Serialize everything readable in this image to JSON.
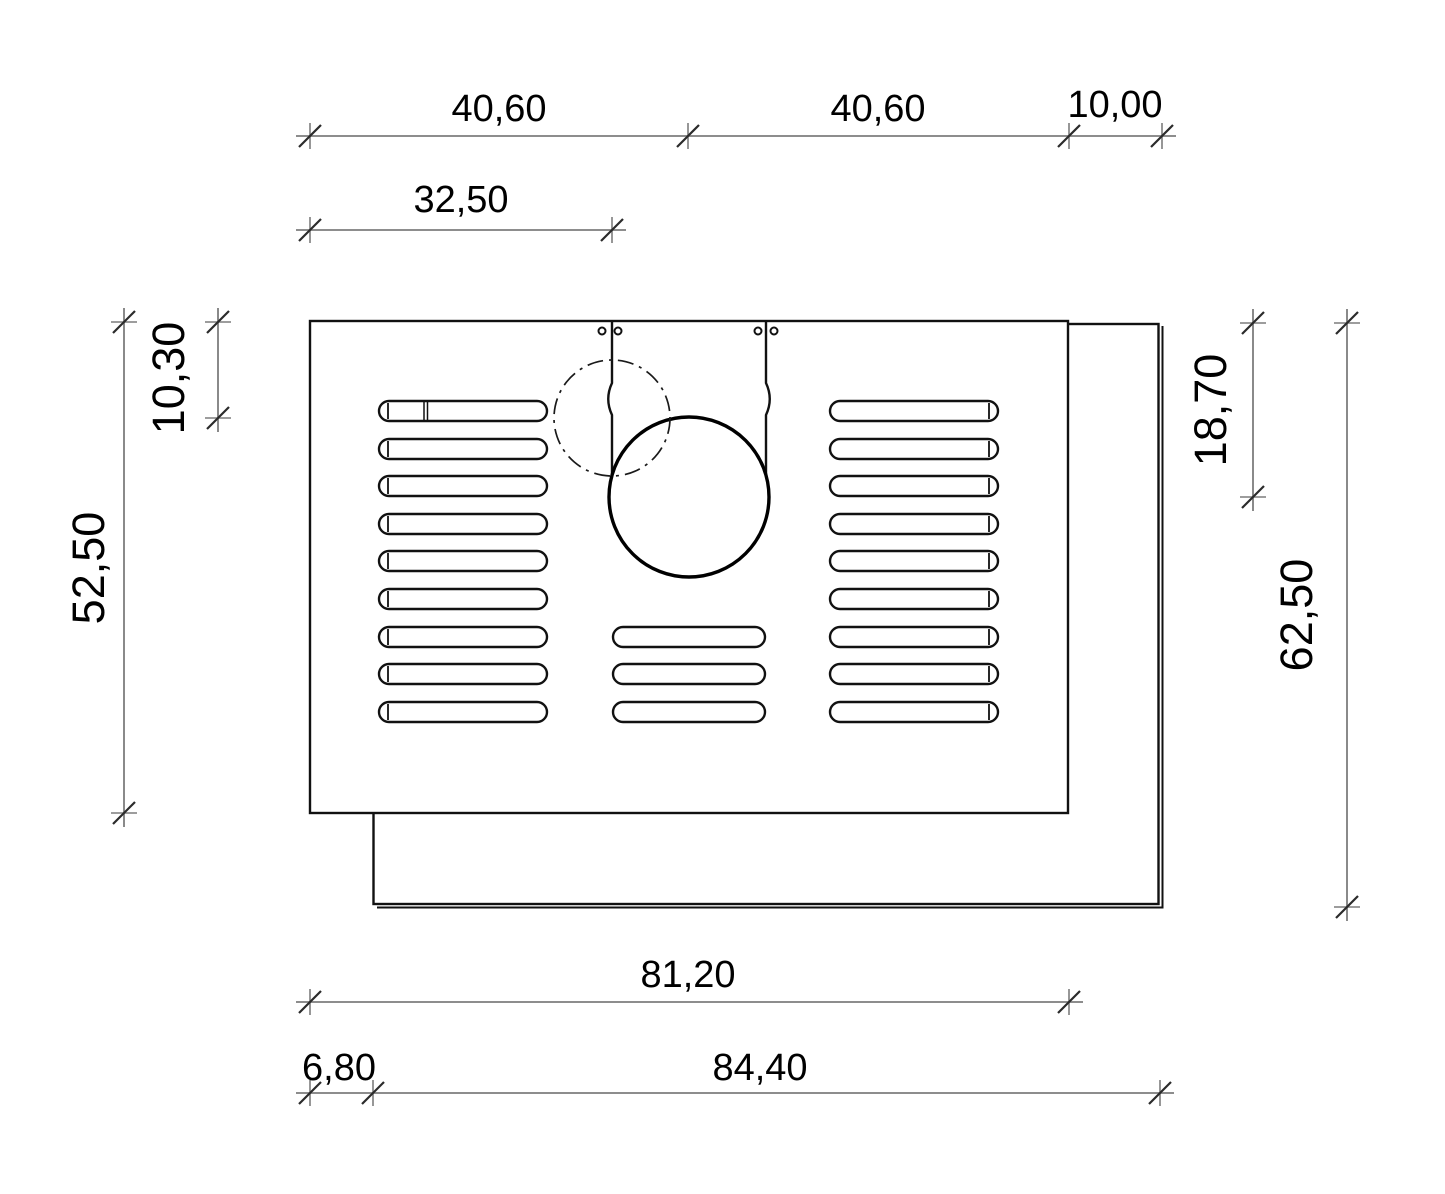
{
  "drawing": {
    "type": "technical-dimension-drawing",
    "dims": {
      "top_left_span": "40,60",
      "top_right_span": "40,60",
      "top_overhang": "10,00",
      "slit_offset": "32,50",
      "front_height": "52,50",
      "centerline_circle_offset": "10,30",
      "flue_center_offset": "18,70",
      "rear_height": "62,50",
      "front_width": "81,20",
      "rear_left_inset": "6,80",
      "rear_width": "84,40"
    },
    "colors": {
      "object_line": "#111111",
      "dimension_line": "#7d7d7d",
      "text": "#000000",
      "background": "#ffffff"
    }
  }
}
